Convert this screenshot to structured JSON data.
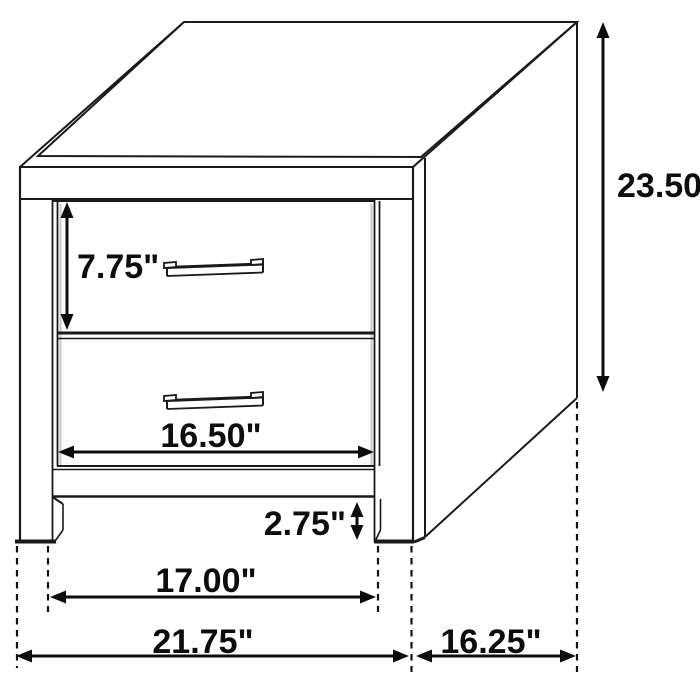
{
  "figure": {
    "kind": "furniture-dimension-diagram",
    "item": "two-drawer nightstand line drawing",
    "background_color": "#ffffff",
    "line_color": "#1a1a1a",
    "text_color": "#0d0d0d"
  },
  "dimensions": {
    "overall_height": {
      "label": "23.50\"",
      "value": 23.5,
      "unit": "in"
    },
    "drawer_height": {
      "label": "7.75\"",
      "value": 7.75,
      "unit": "in"
    },
    "drawer_width": {
      "label": "16.50\"",
      "value": 16.5,
      "unit": "in"
    },
    "base_clearance": {
      "label": "2.75\"",
      "value": 2.75,
      "unit": "in"
    },
    "leg_span_width": {
      "label": "17.00\"",
      "value": 17.0,
      "unit": "in"
    },
    "overall_width": {
      "label": "21.75\"",
      "value": 21.75,
      "unit": "in"
    },
    "overall_depth": {
      "label": "16.25\"",
      "value": 16.25,
      "unit": "in"
    }
  }
}
